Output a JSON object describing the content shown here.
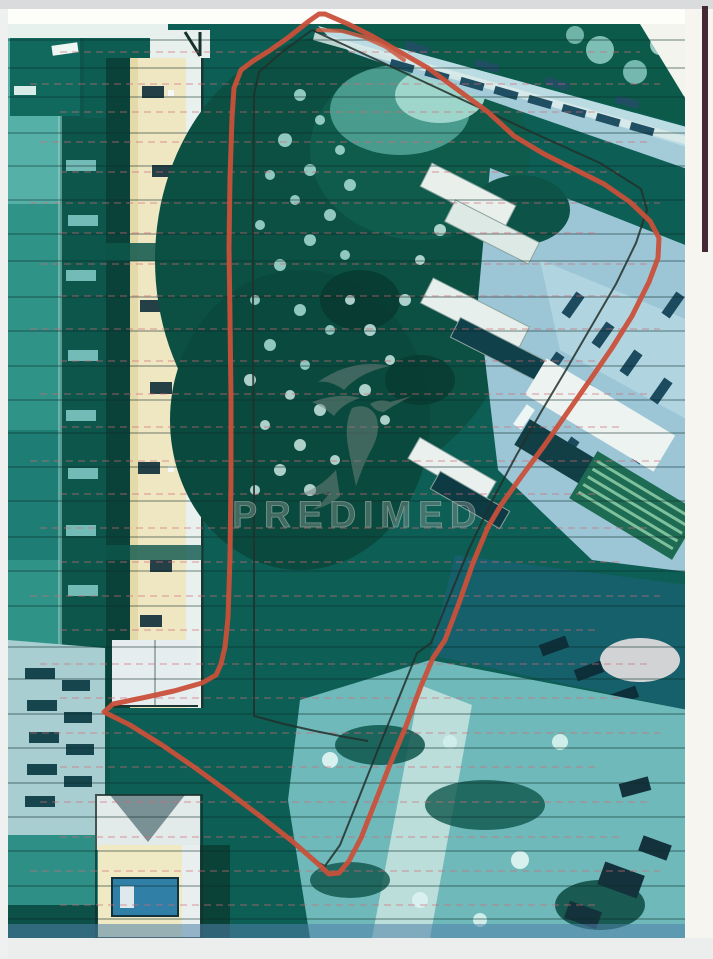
{
  "watermark": {
    "brand": "PREDIMED"
  },
  "overlay": {
    "red_boundary_points": "325,14 348,24 372,36 400,52 428,68 458,90 488,112 514,136 544,154 574,169 604,184 630,202 650,221 659,238 658,258 649,282 632,316 612,348 590,380 567,413 544,446 521,477 501,505 488,527 473,563 459,603 445,640 433,658 421,686 406,726 391,762 376,800 361,838 349,861 339,873 329,874 317,863 292,841 260,816 227,791 194,767 162,745 130,725 104,712 113,704 142,698 174,691 202,683 216,675 221,664 225,647 228,618 230,558 231,478 231,398 230,318 229,248 230,178 232,118 234,88 241,70 253,61 269,51 289,37 309,21 319,14",
    "red_inner_stroke_points": "318,30 342,31 364,37 386,47 404,60",
    "black_main_points": "312,30 364,54 420,80 478,107 538,135 600,163 641,189 647,210 636,243 616,284 591,327 566,370 541,412 516,456 493,499 469,549 449,598 431,643 417,653 396,705 377,752 358,800 340,845 325,866 313,860",
    "black_west_points": "312,30 282,52 259,72 254,95 253,210 253,350 254,480 254,600 254,716 284,724 315,731 345,737 368,741",
    "colors": {
      "boundary_red": "#c9503a",
      "boundary_black": "#22302c",
      "watermark_gray": "#7c8a85",
      "photo_teal": "#0d5e55",
      "roof_cream": "#efe7c2",
      "road_blue": "#a3cbd8",
      "paper": "#fbfbf8"
    }
  }
}
